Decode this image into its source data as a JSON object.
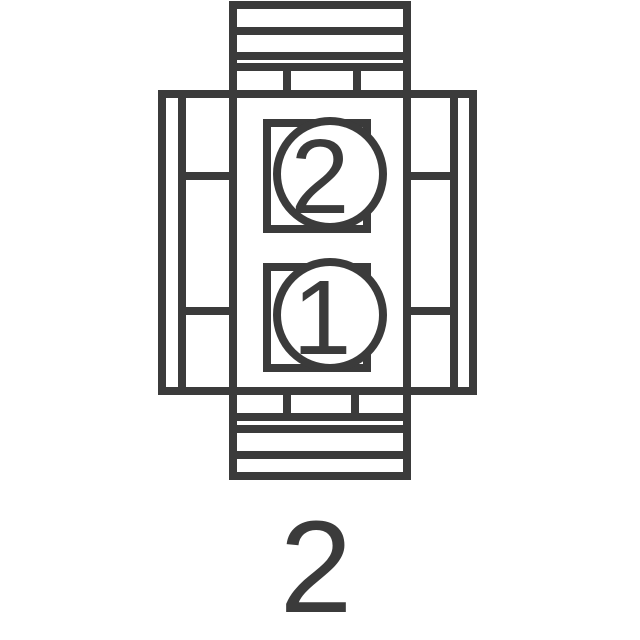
{
  "diagram": {
    "pins": [
      {
        "label": "2"
      },
      {
        "label": "1"
      }
    ],
    "count_label": "2",
    "colors": {
      "line": "#3b3b3b",
      "background": "#ffffff",
      "pin_fill": "#ffffff"
    }
  }
}
